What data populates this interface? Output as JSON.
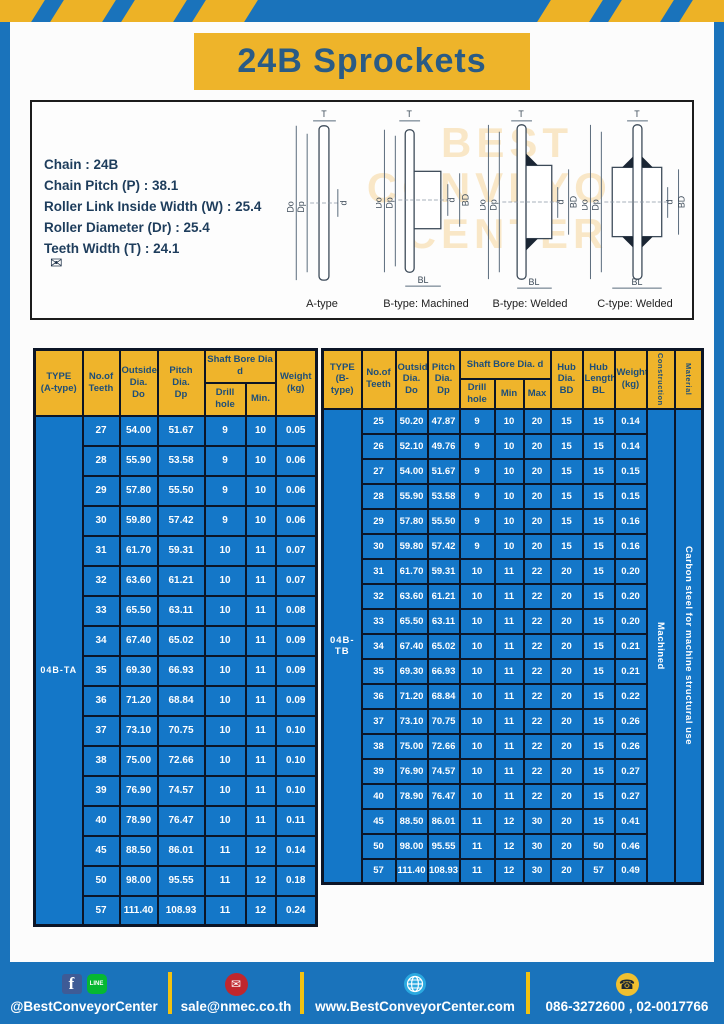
{
  "page": {
    "title": "24B Sprockets"
  },
  "specs": {
    "lines": [
      "Chain : 24B",
      "Chain Pitch (P) : 38.1",
      "Roller Link Inside Width (W) : 25.4",
      "Roller Diameter (Dr) : 25.4",
      "Teeth Width (T) : 24.1"
    ]
  },
  "diagrams": {
    "captions": [
      "A-type",
      "B-type: Machined",
      "B-type: Welded",
      "C-type: Welded"
    ],
    "dim_labels": {
      "t": "T",
      "do": "Do",
      "dp": "Dp",
      "d": "d",
      "bd": "BD",
      "bl": "BL"
    },
    "watermark": {
      "l1": "BEST",
      "l2": "CONVEYOR",
      "l3": "CENTER"
    },
    "envelope_icon": "✉"
  },
  "table_a": {
    "headers": {
      "type": "TYPE\n(A-type)",
      "teeth": "No.of\nTeeth",
      "outside": "Outside\nDia.\nDo",
      "pitch": "Pitch Dia.\nDp",
      "shaft": "Shaft Bore Dia d",
      "drill": "Drill hole",
      "min": "Min.",
      "weight": "Weight\n(kg)"
    },
    "type_value": "04B-TA",
    "rows": [
      [
        "27",
        "54.00",
        "51.67",
        "9",
        "10",
        "0.05"
      ],
      [
        "28",
        "55.90",
        "53.58",
        "9",
        "10",
        "0.06"
      ],
      [
        "29",
        "57.80",
        "55.50",
        "9",
        "10",
        "0.06"
      ],
      [
        "30",
        "59.80",
        "57.42",
        "9",
        "10",
        "0.06"
      ],
      [
        "31",
        "61.70",
        "59.31",
        "10",
        "11",
        "0.07"
      ],
      [
        "32",
        "63.60",
        "61.21",
        "10",
        "11",
        "0.07"
      ],
      [
        "33",
        "65.50",
        "63.11",
        "10",
        "11",
        "0.08"
      ],
      [
        "34",
        "67.40",
        "65.02",
        "10",
        "11",
        "0.09"
      ],
      [
        "35",
        "69.30",
        "66.93",
        "10",
        "11",
        "0.09"
      ],
      [
        "36",
        "71.20",
        "68.84",
        "10",
        "11",
        "0.09"
      ],
      [
        "37",
        "73.10",
        "70.75",
        "10",
        "11",
        "0.10"
      ],
      [
        "38",
        "75.00",
        "72.66",
        "10",
        "11",
        "0.10"
      ],
      [
        "39",
        "76.90",
        "74.57",
        "10",
        "11",
        "0.10"
      ],
      [
        "40",
        "78.90",
        "76.47",
        "10",
        "11",
        "0.11"
      ],
      [
        "45",
        "88.50",
        "86.01",
        "11",
        "12",
        "0.14"
      ],
      [
        "50",
        "98.00",
        "95.55",
        "11",
        "12",
        "0.18"
      ],
      [
        "57",
        "111.40",
        "108.93",
        "11",
        "12",
        "0.24"
      ]
    ]
  },
  "table_b": {
    "headers": {
      "type": "TYPE\n(B-type)",
      "teeth": "No.of\nTeeth",
      "outside": "Outside\nDia.\nDo",
      "pitch": "Pitch\nDia.\nDp",
      "shaft": "Shaft Bore Dia. d",
      "drill": "Drill hole",
      "min": "Min",
      "max": "Max",
      "hub_dia": "Hub\nDia.\nBD",
      "hub_len": "Hub\nLength\nBL",
      "weight": "Weight\n(kg)",
      "construction": "Construction",
      "material": "Material"
    },
    "type_value": "04B-TB",
    "construction_value": "Machined",
    "material_value": "Carbon steel for machine structural use",
    "rows": [
      [
        "25",
        "50.20",
        "47.87",
        "9",
        "10",
        "20",
        "15",
        "15",
        "0.14"
      ],
      [
        "26",
        "52.10",
        "49.76",
        "9",
        "10",
        "20",
        "15",
        "15",
        "0.14"
      ],
      [
        "27",
        "54.00",
        "51.67",
        "9",
        "10",
        "20",
        "15",
        "15",
        "0.15"
      ],
      [
        "28",
        "55.90",
        "53.58",
        "9",
        "10",
        "20",
        "15",
        "15",
        "0.15"
      ],
      [
        "29",
        "57.80",
        "55.50",
        "9",
        "10",
        "20",
        "15",
        "15",
        "0.16"
      ],
      [
        "30",
        "59.80",
        "57.42",
        "9",
        "10",
        "20",
        "15",
        "15",
        "0.16"
      ],
      [
        "31",
        "61.70",
        "59.31",
        "10",
        "11",
        "22",
        "20",
        "15",
        "0.20"
      ],
      [
        "32",
        "63.60",
        "61.21",
        "10",
        "11",
        "22",
        "20",
        "15",
        "0.20"
      ],
      [
        "33",
        "65.50",
        "63.11",
        "10",
        "11",
        "22",
        "20",
        "15",
        "0.20"
      ],
      [
        "34",
        "67.40",
        "65.02",
        "10",
        "11",
        "22",
        "20",
        "15",
        "0.21"
      ],
      [
        "35",
        "69.30",
        "66.93",
        "10",
        "11",
        "22",
        "20",
        "15",
        "0.21"
      ],
      [
        "36",
        "71.20",
        "68.84",
        "10",
        "11",
        "22",
        "20",
        "15",
        "0.22"
      ],
      [
        "37",
        "73.10",
        "70.75",
        "10",
        "11",
        "22",
        "20",
        "15",
        "0.26"
      ],
      [
        "38",
        "75.00",
        "72.66",
        "10",
        "11",
        "22",
        "20",
        "15",
        "0.26"
      ],
      [
        "39",
        "76.90",
        "74.57",
        "10",
        "11",
        "22",
        "20",
        "15",
        "0.27"
      ],
      [
        "40",
        "78.90",
        "76.47",
        "10",
        "11",
        "22",
        "20",
        "15",
        "0.27"
      ],
      [
        "45",
        "88.50",
        "86.01",
        "11",
        "12",
        "30",
        "20",
        "15",
        "0.41"
      ],
      [
        "50",
        "98.00",
        "95.55",
        "11",
        "12",
        "30",
        "20",
        "50",
        "0.46"
      ],
      [
        "57",
        "111.40",
        "108.93",
        "11",
        "12",
        "30",
        "20",
        "57",
        "0.49"
      ]
    ]
  },
  "footer": {
    "social_label": "@BestConveyorCenter",
    "fb_glyph": "f",
    "line_glyph": "LINE",
    "mail_glyph": "✉",
    "phone_glyph": "☎",
    "email": "sale@nmec.co.th",
    "website": "www.BestConveyorCenter.com",
    "phones": "086-3272600 , 02-0017766"
  },
  "colors": {
    "page_blue": "#1a73bb",
    "accent_yellow": "#eeb42a",
    "table_cell_blue": "#1477c8",
    "table_border_navy": "#0c1526",
    "title_text_blue": "#2a5b85"
  }
}
